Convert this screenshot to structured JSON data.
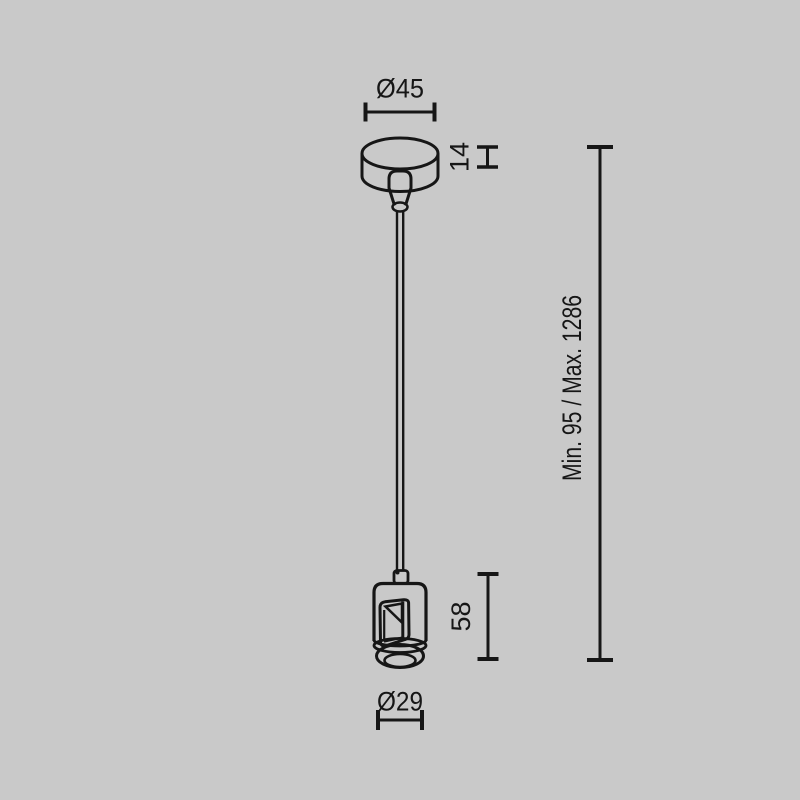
{
  "canvas": {
    "bg_color": "#c9c9c9",
    "line_color": "#161616"
  },
  "diagram": {
    "subject": "pendant-suspension-kit",
    "parts": [
      "ceiling-canopy",
      "suspension-wire",
      "lamp-holder"
    ],
    "dimensions": {
      "canopy_diameter": "Ø45",
      "canopy_height": "14",
      "suspension_length": "Min. 95 / Max. 1286",
      "holder_height": "58",
      "holder_diameter": "Ø29"
    }
  }
}
